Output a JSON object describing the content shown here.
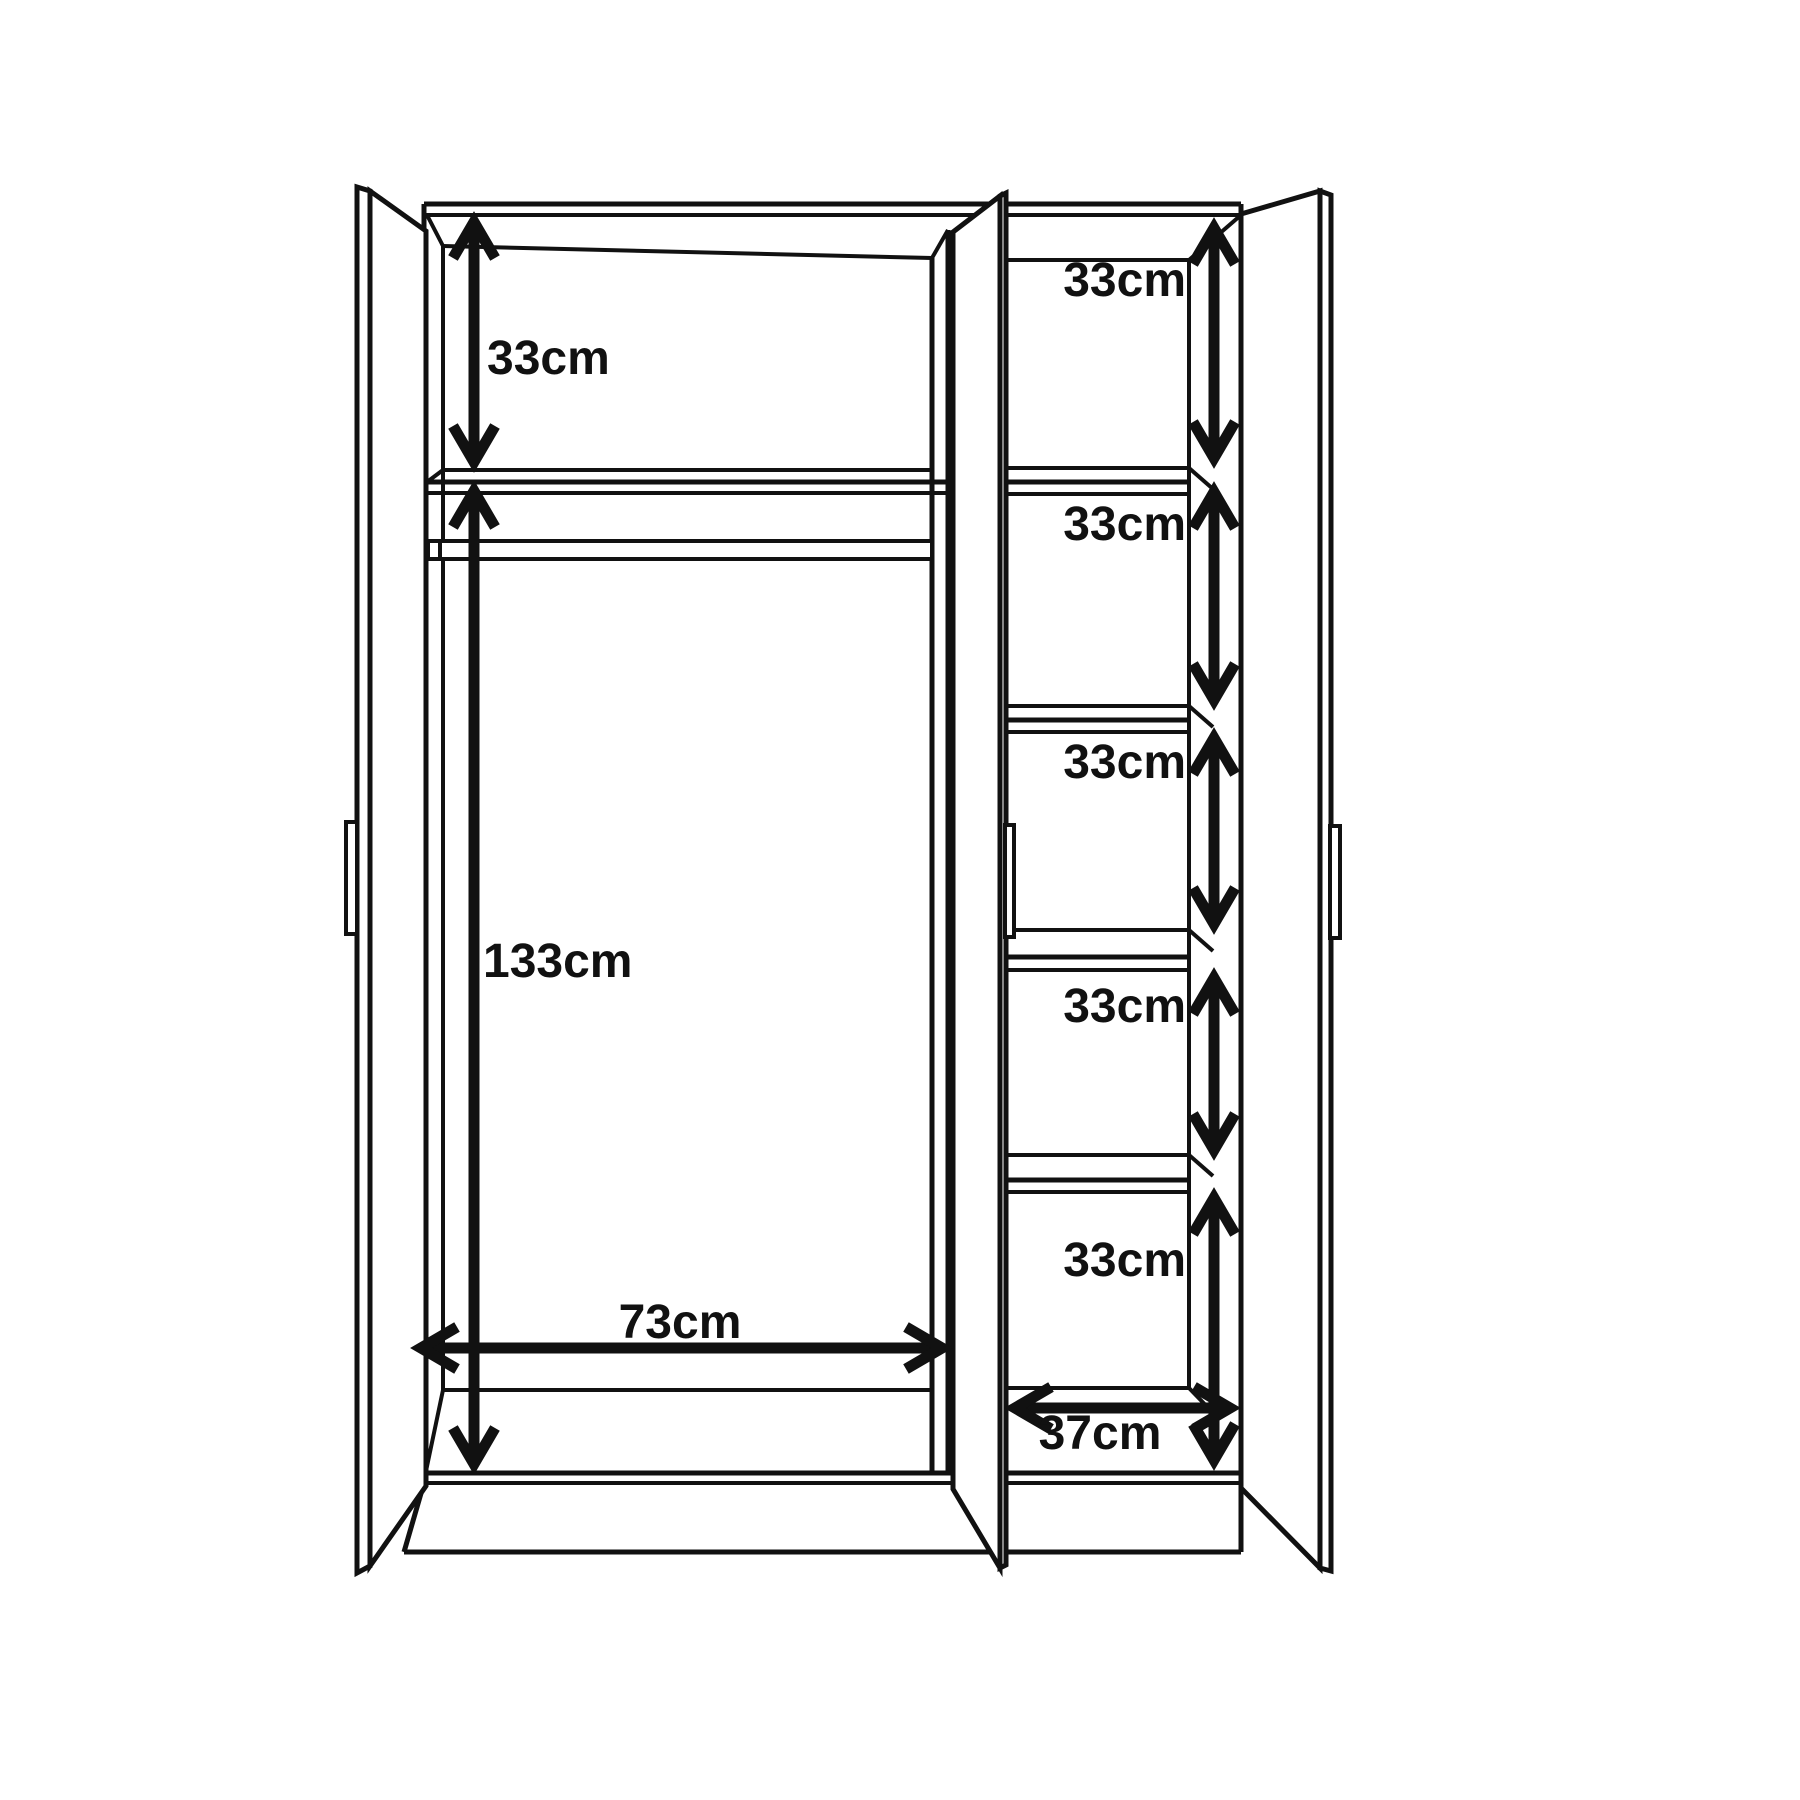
{
  "dimensions": {
    "left_top_shelf": "33cm",
    "left_hanging_space": "133cm",
    "left_compartment_width": "73cm",
    "right_shelf_gaps": [
      "33cm",
      "33cm",
      "33cm",
      "33cm",
      "33cm"
    ],
    "right_compartment_width": "37cm"
  },
  "colors": {
    "line": "#111111",
    "background": "#ffffff"
  }
}
